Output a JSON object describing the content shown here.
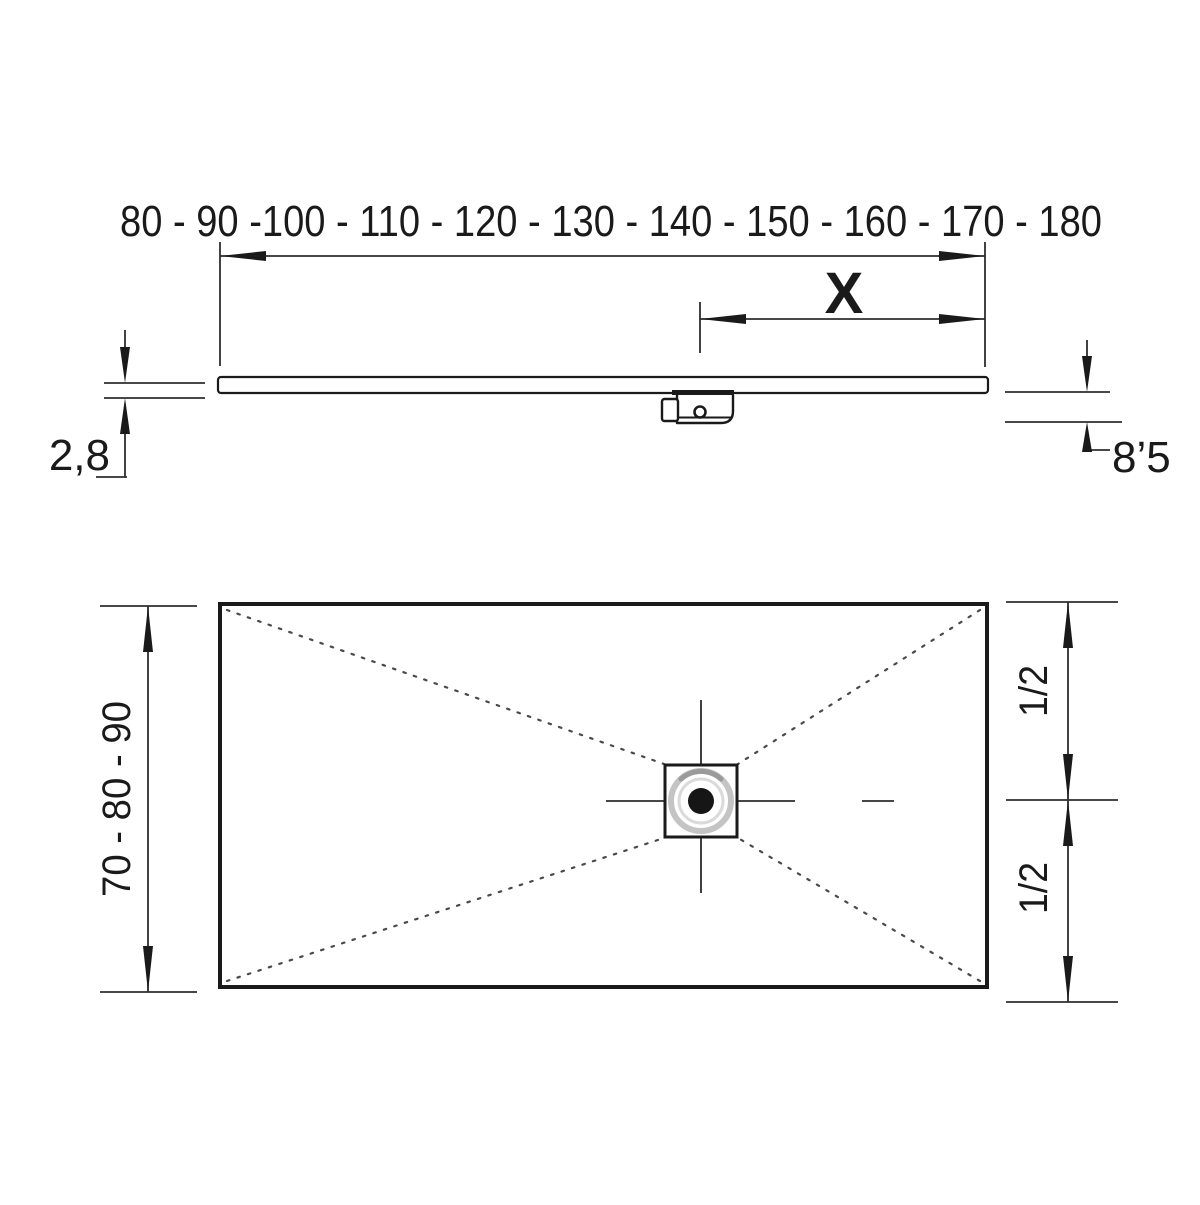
{
  "drawing": {
    "type": "shower-tray technical drawing",
    "ink_color": "#1a1a1a",
    "dim_line_color": "#2e2e2e",
    "dotted_line_color": "#4a4a4a",
    "drain_ring_color": "#c4c4c4",
    "background_color": "#ffffff"
  },
  "side_view": {
    "length_options_label": "80 - 90 -100 - 110 - 120 - 130 - 140 - 150 - 160 - 170 - 180",
    "drain_to_edge_label": "X",
    "tray_thickness_label": "2,8",
    "total_height_label": "8’5"
  },
  "plan_view": {
    "width_options_label": "70 - 80 - 90",
    "half_width_top_label": "1/2",
    "half_width_bottom_label": "1/2"
  }
}
